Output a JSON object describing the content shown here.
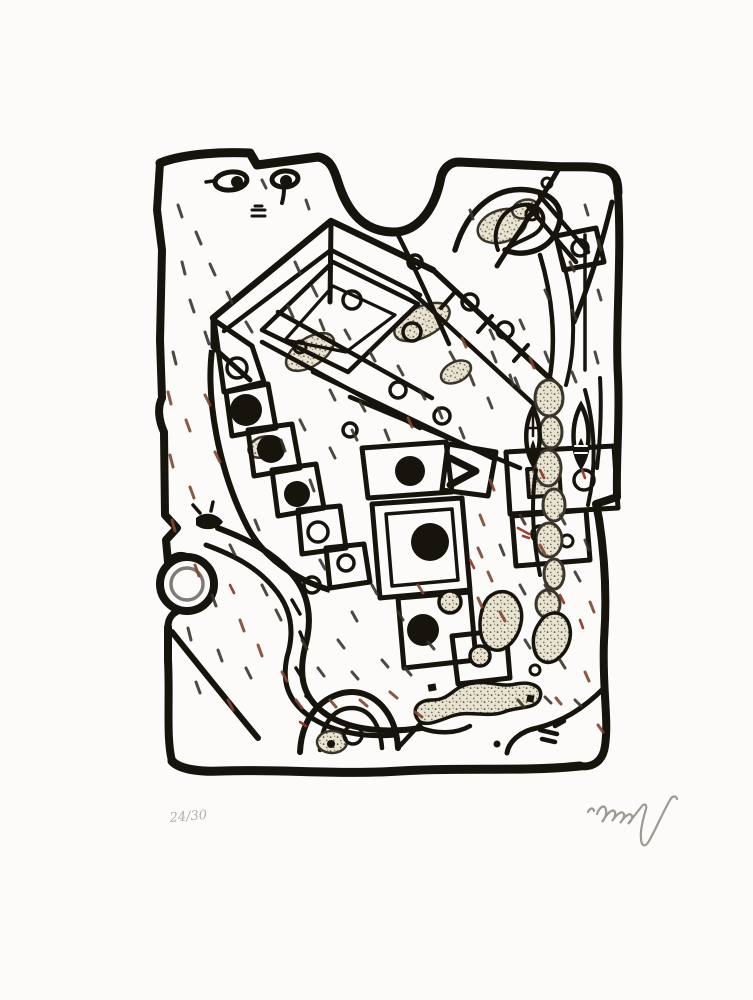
{
  "print": {
    "edition_number": "24/30",
    "signature": "Alechinsky",
    "description": "Abstract expressionist print in black ink on white paper: a thick irregular hand-drawn frame with a deep notch at the top encloses an angular maze-like structure, chains of tilted rectangles holding black dots and small circles, a serpentine band in the lower left, stippled organic pod and totem shapes on the right, and scattered short hatch marks in black and sepia. Pencil edition number at lower left and artist signature scrawl at lower right.",
    "colors": {
      "paper": "#fcfbf9",
      "ink": "#17130d",
      "pencil": "#9a958c",
      "hatch_dark": "#3a342b",
      "hatch_sepia": "#7c4734",
      "accent_red": "#8f3a2a",
      "texture_fill": "#e8e2d1",
      "texture_dot": "#57503f"
    }
  }
}
